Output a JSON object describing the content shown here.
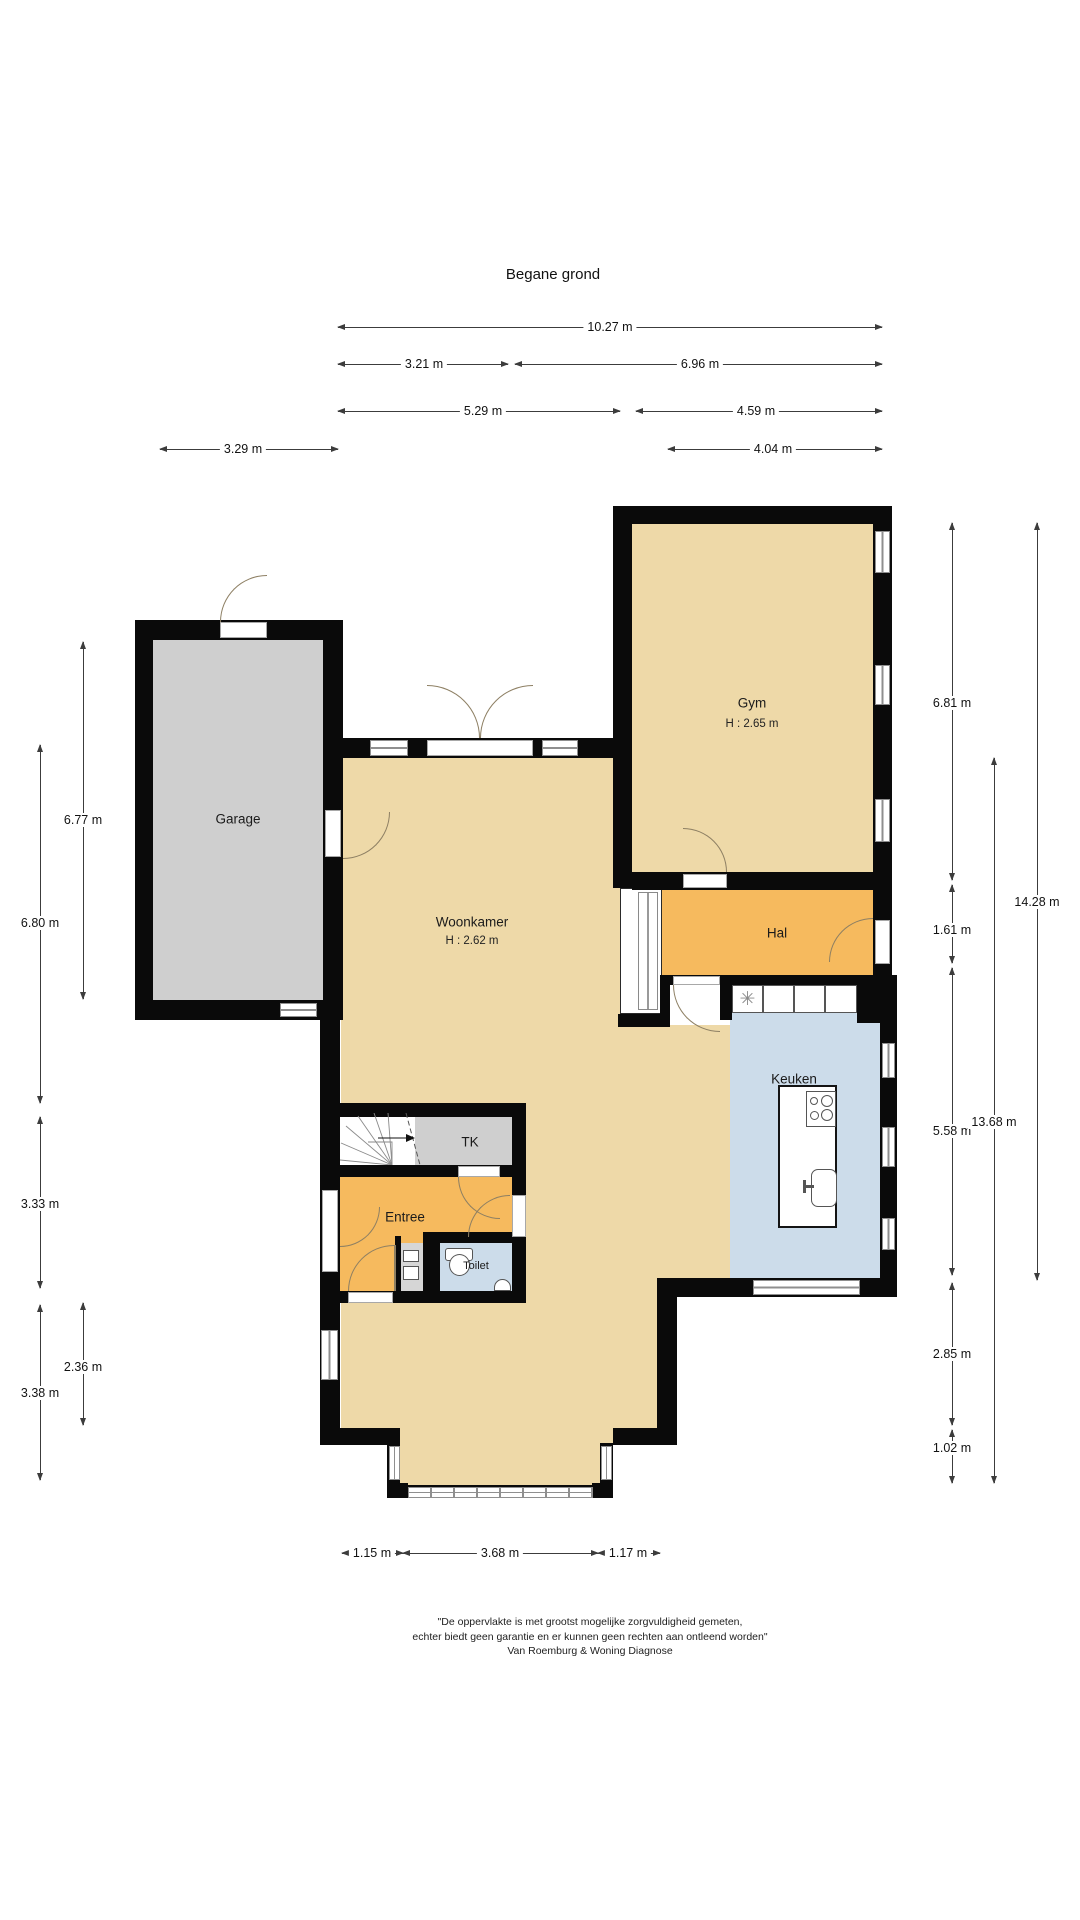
{
  "title": "Begane grond",
  "colors": {
    "wall": "#0a0a0a",
    "beige": "#eed9a8",
    "orange": "#f6ba5e",
    "gray": "#cfcfcf",
    "blue": "#ccdcea",
    "frame": "#8f8f8f",
    "arc": "#8d7f63",
    "dim": "#3c3c3c"
  },
  "rooms": {
    "gym": {
      "name": "Gym",
      "height": "H : 2.65 m"
    },
    "garage": {
      "name": "Garage"
    },
    "woonkamer": {
      "name": "Woonkamer",
      "height": "H : 2.62 m"
    },
    "hal": {
      "name": "Hal"
    },
    "keuken": {
      "name": "Keuken"
    },
    "tk": {
      "name": "TK"
    },
    "entree": {
      "name": "Entree"
    },
    "toilet": {
      "name": "Toilet"
    }
  },
  "icons": {
    "ventilation": "✳"
  },
  "dimensions": {
    "top": [
      "10.27 m",
      "3.21 m",
      "6.96 m",
      "5.29 m",
      "4.59 m",
      "3.29 m",
      "4.04 m"
    ],
    "bottom": [
      "1.15 m",
      "3.68 m",
      "1.17 m"
    ],
    "left": [
      "6.77 m",
      "6.80 m",
      "3.33 m",
      "2.36 m",
      "3.38 m"
    ],
    "right": [
      "6.81 m",
      "1.61 m",
      "5.58 m",
      "2.85 m",
      "1.02 m",
      "13.68 m",
      "14.28 m"
    ]
  },
  "footer": {
    "line1": "\"De oppervlakte is met grootst mogelijke zorgvuldigheid gemeten,",
    "line2": "echter biedt geen garantie en er kunnen geen rechten aan ontleend worden\"",
    "line3": "Van Roemburg & Woning Diagnose"
  }
}
